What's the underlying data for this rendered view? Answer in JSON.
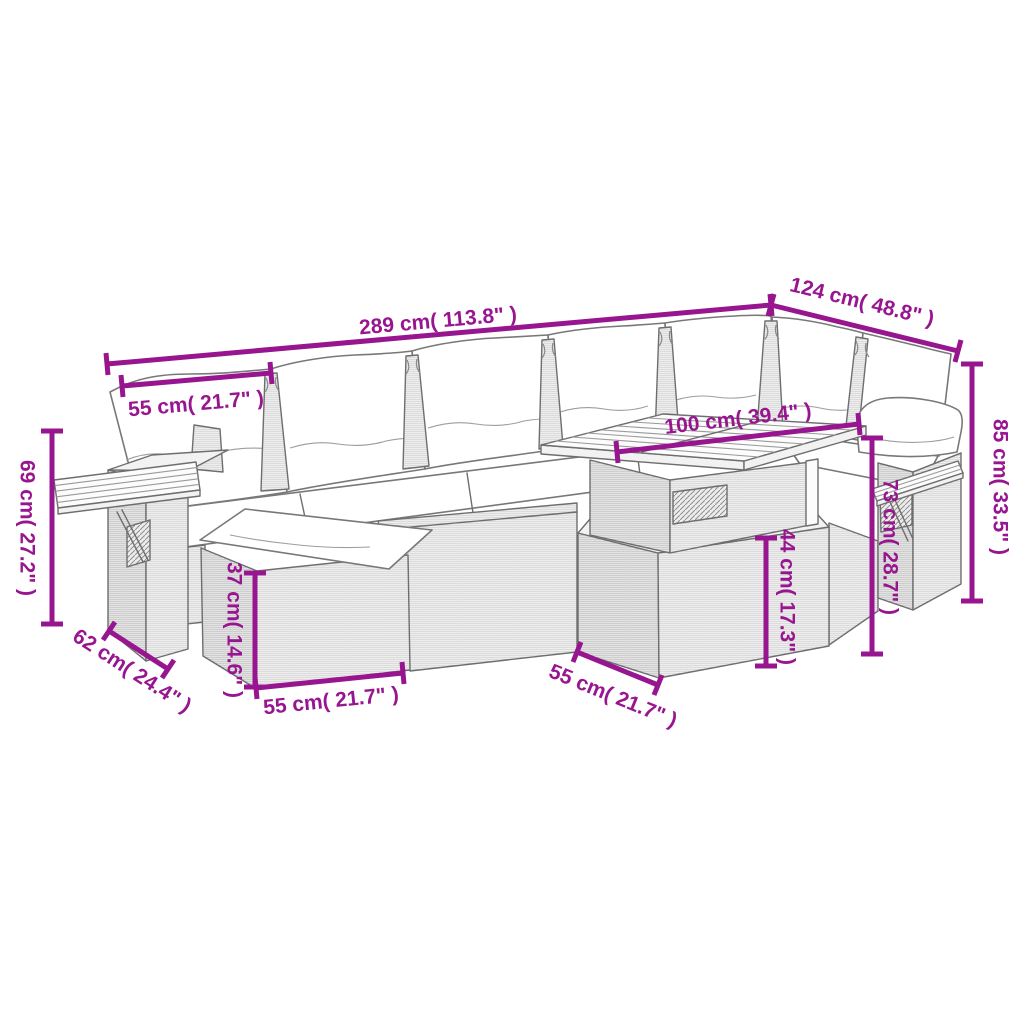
{
  "page": {
    "background": "#ffffff"
  },
  "colors": {
    "accent": "#981590",
    "line_art": "#6e6e6e",
    "wicker_texture": "#c6c6c6"
  },
  "figure": {
    "description": "Line drawing of a 7-piece poly rattan garden corner sofa set with cushions, ottoman and slatted wood table, annotated with dimensions"
  },
  "dims": {
    "overall_width": "289 cm( 113.8\" )",
    "corner_depth": "124 cm( 48.8\" )",
    "overall_height": "85 cm( 33.5\" )",
    "back_cushion_width": "55 cm( 21.7\" )",
    "table_length": "100 cm( 39.4\" )",
    "right_panel_height": "73 cm( 28.7\" )",
    "table_height": "44 cm( 17.3\" )",
    "table_depth": "55 cm( 21.7\" )",
    "ottoman_height": "37 cm( 14.6\" )",
    "ottoman_width": "55 cm( 21.7\" )",
    "seat_depth": "62 cm( 24.4\" )",
    "left_arm_height": "69 cm( 27.2\" )"
  }
}
